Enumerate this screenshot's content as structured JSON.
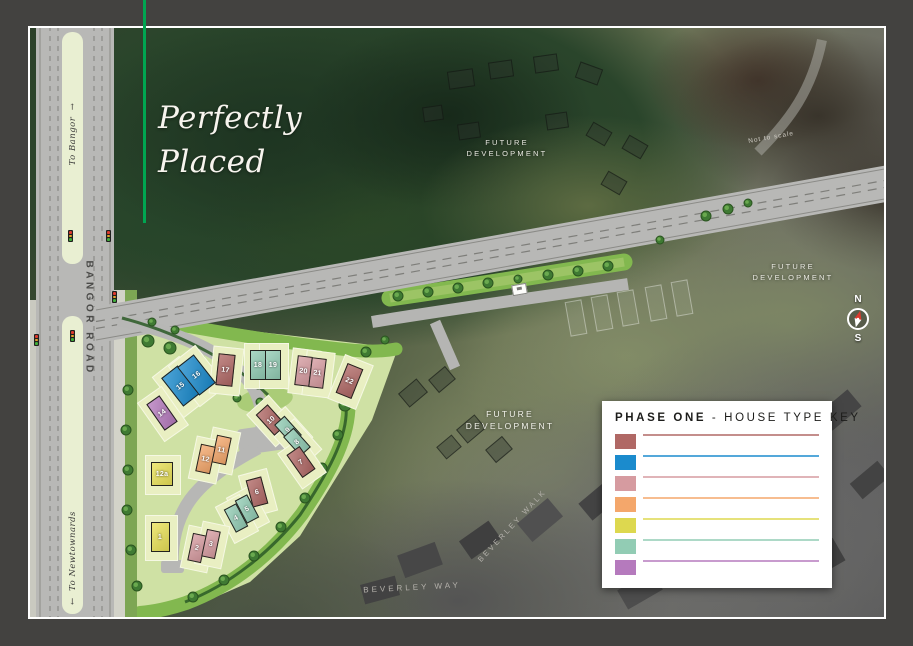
{
  "hero": {
    "line1": "Perfectly",
    "line2": "Placed"
  },
  "labels": {
    "bangor_road": "BANGOR ROAD",
    "to_bangor": "To Bangor",
    "to_bangor_arrow": "→",
    "to_newtownards": "To Newtownards",
    "to_newtownards_arrow": "←",
    "future_line1": "FUTURE",
    "future_line2": "DEVELOPMENT",
    "not_to_scale": "Not to scale",
    "beverley_walk": "BEVERLEY WALK",
    "beverley_way": "BEVERLEY WAY",
    "compass_north": "N",
    "compass_south": "S"
  },
  "legend": {
    "title_bold": "PHASE ONE",
    "title_rest": " - HOUSE TYPE KEY",
    "entries": [
      {
        "prefix": "THE",
        "name": "MAYNE",
        "sites": "– Sites: 6, 7, 10, 17, 22",
        "details": "With Sunroom 979 sq. ft. approx. / Without Sunroom 879 sq. ft. approx.",
        "color": "#b06865"
      },
      {
        "prefix": "THE",
        "name": "BLEAKLEY",
        "sites": "– Sites: 15, 16",
        "details": "With Sunroom 1,366 sq. ft. approx.",
        "color": "#1b8bcd"
      },
      {
        "prefix": "THE",
        "name": "COLVILLE",
        "sites": "– Sites: 2, 3, 20, 21",
        "details": "With Sunroom 988 sq. ft. approx. / Without Sunroom 888 sq. ft. approx.",
        "color": "#d69ba0"
      },
      {
        "prefix": "THE",
        "name": "WARWICK",
        "sites": "– Sites: 11, 12",
        "details": "With Sunroom 1,081 sq. ft. approx.",
        "color": "#f4a76b"
      },
      {
        "prefix": "THE",
        "name": "McLENAGHAN",
        "sites": "– Sites: 1, 12a",
        "details": "With Sunroom 1,162 sq. ft. approx. / Without Sunroom 1,062 sq. ft. approx.",
        "color": "#ddd84f"
      },
      {
        "prefix": "THE",
        "name": "LEGGE",
        "sites": "– Sites: 4, 5, 8, 9, 18, 19",
        "details": "With Sunroom 988 sq. ft. approx.",
        "color": "#92ccb4"
      },
      {
        "prefix": "THE",
        "name": "EARL",
        "sites": "– Site: 14",
        "details": "1,089 sq. ft. approx.",
        "color": "#b57abd"
      }
    ]
  },
  "site": {
    "house_colors": {
      "mayne": "#b06865",
      "bleakley": "#1b8bcd",
      "colville": "#d69ba0",
      "warwick": "#f4a76b",
      "mclenaghan": "#e9e157",
      "legge": "#92ccb4",
      "earl": "#b57abd"
    },
    "houses": [
      {
        "n": "15",
        "type": "bleakley",
        "cx": 180,
        "cy": 386,
        "w": 21,
        "h": 36,
        "r": -38
      },
      {
        "n": "16",
        "type": "bleakley",
        "cx": 196,
        "cy": 375,
        "w": 21,
        "h": 36,
        "r": -38
      },
      {
        "n": "17",
        "type": "mayne",
        "cx": 225,
        "cy": 370,
        "w": 17,
        "h": 32,
        "r": 6
      },
      {
        "n": "18",
        "type": "legge",
        "cx": 258,
        "cy": 365,
        "w": 16,
        "h": 30,
        "r": 0
      },
      {
        "n": "19",
        "type": "legge",
        "cx": 273,
        "cy": 365,
        "w": 16,
        "h": 30,
        "r": 0
      },
      {
        "n": "20",
        "type": "colville",
        "cx": 303,
        "cy": 371,
        "w": 15,
        "h": 30,
        "r": 7
      },
      {
        "n": "21",
        "type": "colville",
        "cx": 317,
        "cy": 373,
        "w": 15,
        "h": 30,
        "r": 7
      },
      {
        "n": "22",
        "type": "mayne",
        "cx": 349,
        "cy": 381,
        "w": 17,
        "h": 32,
        "r": 22
      },
      {
        "n": "14",
        "type": "earl",
        "cx": 162,
        "cy": 413,
        "w": 16,
        "h": 32,
        "r": -35
      },
      {
        "n": "10",
        "type": "mayne",
        "cx": 271,
        "cy": 420,
        "w": 16,
        "h": 28,
        "r": -42
      },
      {
        "n": "9",
        "type": "legge",
        "cx": 288,
        "cy": 430,
        "w": 14,
        "h": 26,
        "r": -42
      },
      {
        "n": "8",
        "type": "legge",
        "cx": 297,
        "cy": 442,
        "w": 14,
        "h": 26,
        "r": -42
      },
      {
        "n": "7",
        "type": "mayne",
        "cx": 301,
        "cy": 462,
        "w": 16,
        "h": 28,
        "r": -35
      },
      {
        "n": "11",
        "type": "warwick",
        "cx": 221,
        "cy": 450,
        "w": 15,
        "h": 28,
        "r": 12
      },
      {
        "n": "12",
        "type": "warwick",
        "cx": 205,
        "cy": 459,
        "w": 15,
        "h": 28,
        "r": 12
      },
      {
        "n": "12a",
        "type": "mclenaghan",
        "cx": 162,
        "cy": 474,
        "w": 22,
        "h": 24,
        "r": 0
      },
      {
        "n": "6",
        "type": "mayne",
        "cx": 257,
        "cy": 492,
        "w": 16,
        "h": 28,
        "r": -15
      },
      {
        "n": "5",
        "type": "legge",
        "cx": 247,
        "cy": 509,
        "w": 14,
        "h": 26,
        "r": -28
      },
      {
        "n": "4",
        "type": "legge",
        "cx": 236,
        "cy": 518,
        "w": 14,
        "h": 26,
        "r": -28
      },
      {
        "n": "1",
        "type": "mclenaghan",
        "cx": 160,
        "cy": 537,
        "w": 19,
        "h": 30,
        "r": 0
      },
      {
        "n": "2",
        "type": "colville",
        "cx": 197,
        "cy": 548,
        "w": 14,
        "h": 28,
        "r": 12
      },
      {
        "n": "3",
        "type": "colville",
        "cx": 211,
        "cy": 544,
        "w": 14,
        "h": 28,
        "r": 12
      }
    ]
  }
}
